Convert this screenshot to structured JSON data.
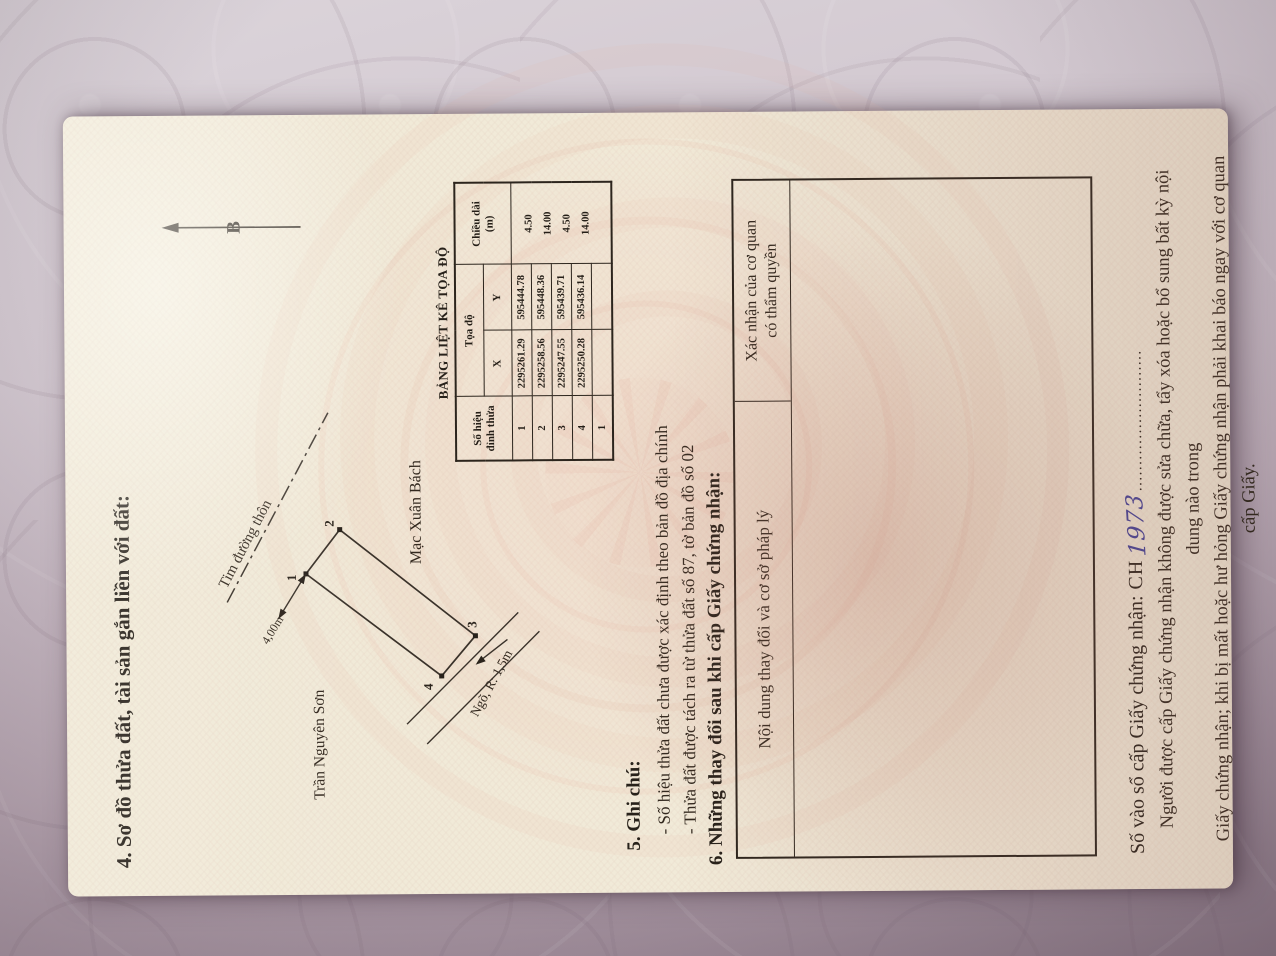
{
  "document": {
    "section4": {
      "title": "4. Sơ đồ thửa đất, tài sản gắn liền với đất:"
    },
    "north": {
      "label": "B"
    },
    "diagram": {
      "road_label": "Tim đường thôn",
      "dimension_label": "4,00m",
      "alley_label": "Ngõ, R: 1,5m",
      "neighbor_west": "Trần Nguyên Sơn",
      "neighbor_east": "Mạc Xuân Bách",
      "vertices": [
        "1",
        "2",
        "3",
        "4"
      ]
    },
    "coord_table": {
      "title": "BẢNG LIỆT KÊ TỌA ĐỘ",
      "header": {
        "vertex_line1": "Số hiệu",
        "vertex_line2": "đỉnh thửa",
        "coords": "Tọa độ",
        "x": "X",
        "y": "Y",
        "length_line1": "Chiều dài",
        "length_line2": "(m)"
      },
      "rows": [
        {
          "id": "1",
          "x": "2295261.29",
          "y": "595444.78"
        },
        {
          "id": "2",
          "x": "2295258.56",
          "y": "595448.36"
        },
        {
          "id": "3",
          "x": "2295247.55",
          "y": "595439.71"
        },
        {
          "id": "4",
          "x": "2295250.28",
          "y": "595436.14"
        },
        {
          "id": "1",
          "x": "",
          "y": ""
        }
      ],
      "edge_lengths": [
        "4.50",
        "14.00",
        "4.50",
        "14.00"
      ]
    },
    "section5": {
      "title": "5. Ghi chú:",
      "notes": [
        "- Số hiệu thửa đất chưa được xác định theo bản đồ địa chính",
        "- Thửa đất được tách ra từ thửa đất số 87, tờ bản đồ số 02"
      ]
    },
    "section6": {
      "title": "6. Những thay đổi sau khi cấp Giấy chứng nhận:",
      "table": {
        "col1": "Nội dung thay đổi và cơ sở pháp lý",
        "col2_line1": "Xác nhận của cơ quan",
        "col2_line2": "có thẩm quyền"
      }
    },
    "registry": {
      "label": "Số vào sổ cấp Giấy chứng nhận:",
      "prefix": "CH",
      "number": "1973",
      "dots": "..........................."
    },
    "footer_note": {
      "line1": "Người được cấp Giấy chứng nhận không được sửa chữa, tẩy xóa hoặc bổ sung bất kỳ nội dung nào trong",
      "line2": "Giấy chứng nhận; khi bị mất hoặc hư hỏng Giấy chứng nhận phải khai báo ngay với cơ quan cấp Giấy."
    }
  }
}
